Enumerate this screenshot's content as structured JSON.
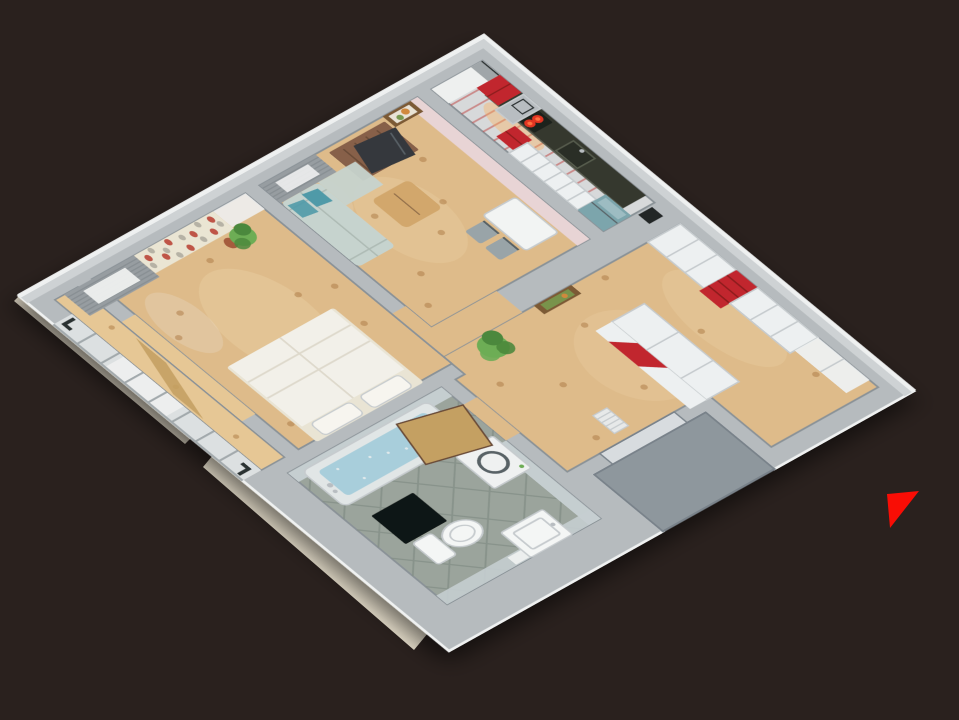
{
  "scene": {
    "type": "3d-apartment-floor-plan-render",
    "view": "top-down axonometric cutaway, rotated about 40 degrees",
    "marker": {
      "name": "red-direction-arrow",
      "shape": "triangle"
    }
  },
  "rooms": [
    {
      "id": "kitchen",
      "objects": [
        "window with sheer curtain",
        "red tall cabinet",
        "steel chimney hood",
        "red box shelf",
        "white cabinet run",
        "dark countertop",
        "cooktop with glowing red burners",
        "sink",
        "teal refrigerator",
        "red striped tile floor"
      ]
    },
    {
      "id": "living-room",
      "objects": [
        "framed picture",
        "brown chest of drawers",
        "flat tv",
        "gray curtains",
        "sage sofa with teal pillows",
        "wood coffee table",
        "white dining table",
        "two chairs",
        "pink partition wall"
      ]
    },
    {
      "id": "bedroom",
      "objects": [
        "floral wallpaper panel",
        "gray curtains with bright window",
        "double bed with white duvet",
        "potted plant"
      ]
    },
    {
      "id": "balcony",
      "objects": [
        "glazed window band with dark brackets",
        "wood plank floor"
      ]
    },
    {
      "id": "hallway",
      "objects": [
        "white wardrobes",
        "red open shelf unit",
        "wardrobe with red stripe",
        "floor vent grille",
        "green plant",
        "framed picture",
        "entrance landing",
        "entrance door"
      ]
    },
    {
      "id": "bathroom",
      "objects": [
        "bathtub with blue water",
        "washing machine",
        "wooden door",
        "toilet",
        "wash basin",
        "light bar",
        "black mat",
        "sage tile floor"
      ]
    }
  ],
  "colors": {
    "background": "#2a211e",
    "slab_cream": "#e8e0cd",
    "wall_top": "#b6bbbe",
    "wall_top_light": "#ced2d4",
    "wall_rim": "#eff1f1",
    "wall_shadow": "#8a9297",
    "landing_gray": "#8e979d",
    "landing_edge": "#79828a",
    "wood_floor": "#debb8a",
    "wood_floor_light": "#ecd2a4",
    "wood_knot": "#b07f4a",
    "balcony_wood": "#e6c795",
    "glazing_pane": "#dce0e1",
    "glazing_frame": "#a2a9ac",
    "bracket_dark": "#2c3033",
    "sheer_white": "#eef0ef",
    "curtain_gray": "#979da1",
    "curtain_line": "#7f868a",
    "kitchen_floor": "#d7d9da",
    "kitchen_stripe": "#bf4a48",
    "counter_dark": "#34372d",
    "counter_edge": "#5c6052",
    "cooktop_black": "#1f221e",
    "burner_red": "#e23522",
    "burner_hot": "#ff7040",
    "glow_warm": "#ffaf56",
    "sink_dark": "#2b2e27",
    "sink_rim": "#565b4d",
    "cabinet_white": "#edf0f1",
    "cabinet_seam": "#c6cbce",
    "cabinet_red": "#c1272d",
    "cabinet_red_dark": "#8c1b1f",
    "chimney_silver": "#b8bdc1",
    "fridge_teal": "#7ca5ac",
    "fridge_teal_light": "#9dbcc2",
    "wall_pink": "#e8d4d5",
    "sofa_sage": "#c6d3ce",
    "sofa_line": "#aebbb5",
    "pillow_teal": "#4f9aa8",
    "table_wood": "#d2a76c",
    "table_white": "#f2f4f3",
    "chair_gray": "#99a4a8",
    "dresser_brown": "#876149",
    "dresser_line": "#6b4c37",
    "tv_dark": "#34393c",
    "tv_sheen": "#596066",
    "frame_brown": "#7c5a36",
    "art_cream": "#e9e3d5",
    "art_orange": "#d0893d",
    "art_green": "#79994f",
    "bed_white": "#f2f0e9",
    "bed_fold": "#d8d3c4",
    "pillow_cream": "#e9e4d4",
    "pillow_white": "#f7f5ef",
    "wallpaper_cream": "#eae5d3",
    "wallpaper_red": "#bf5547",
    "wallpaper_gray": "#b6b2a5",
    "plant_green": "#6dad55",
    "plant_green_dark": "#4c883c",
    "pot_terracotta": "#a55b3e",
    "bath_floor": "#9ba49c",
    "bath_grout": "#848f87",
    "bath_wall_tile": "#c5ced0",
    "tub_shell": "#e1e6e6",
    "tub_water": "#a8cedb",
    "washer_white": "#eff1f1",
    "washer_door": "#586266",
    "ceramic_white": "#f4f6f5",
    "door_wood": "#c4a062",
    "mat_black": "#111412",
    "vent_white": "#e7e9e9",
    "entrance_door": "#d8dcdf",
    "duct_dark": "#222528",
    "arrow_red": "#f90d05"
  }
}
